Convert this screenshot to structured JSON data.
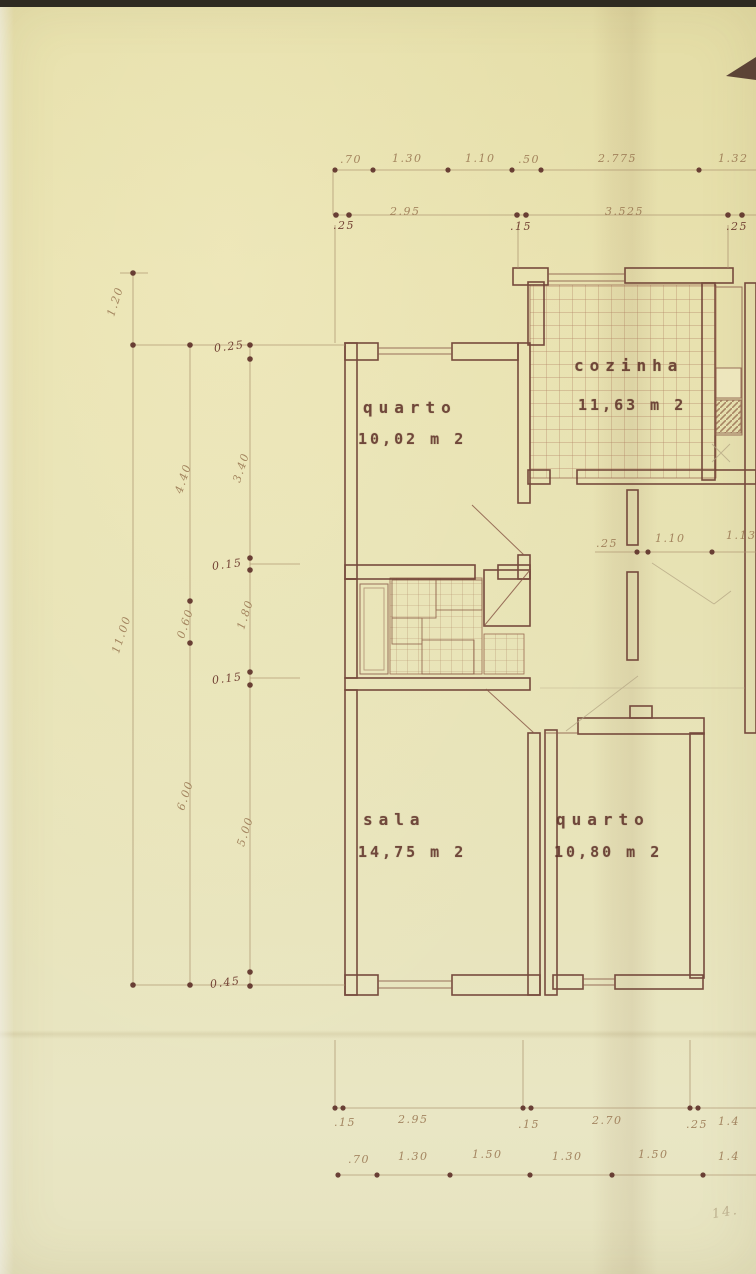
{
  "rooms": [
    {
      "name": "quarto",
      "area": "10,02 m 2"
    },
    {
      "name": "cozinha",
      "area": "11,63 m 2"
    },
    {
      "name": "sala",
      "area": "14,75 m 2"
    },
    {
      "name": "quarto",
      "area": "10,80 m 2"
    }
  ],
  "dims": {
    "top_upper": [
      ".70",
      "1.30",
      "1.10",
      ".50",
      "2.775",
      "1.32"
    ],
    "top_lower": [
      ".25",
      "2.95",
      ".15",
      "3.525",
      ".25"
    ],
    "left_outer": [
      "1.20",
      "11.00"
    ],
    "left_mid": [
      "4.40",
      "0.60",
      "6.00"
    ],
    "left_inner": [
      "0.25",
      "3.40",
      "0.15",
      "1.80",
      "0.15",
      "5.00",
      "0.45"
    ],
    "middle": [
      ".25",
      "1.10",
      "1.13"
    ],
    "bottom_upper": [
      ".15",
      "2.95",
      ".15",
      "2.70",
      ".25",
      "1.4"
    ],
    "bottom_lower": [
      ".70",
      "1.30",
      "1.50",
      "1.30",
      "1.50",
      "1.4"
    ],
    "corner_note": "14."
  }
}
